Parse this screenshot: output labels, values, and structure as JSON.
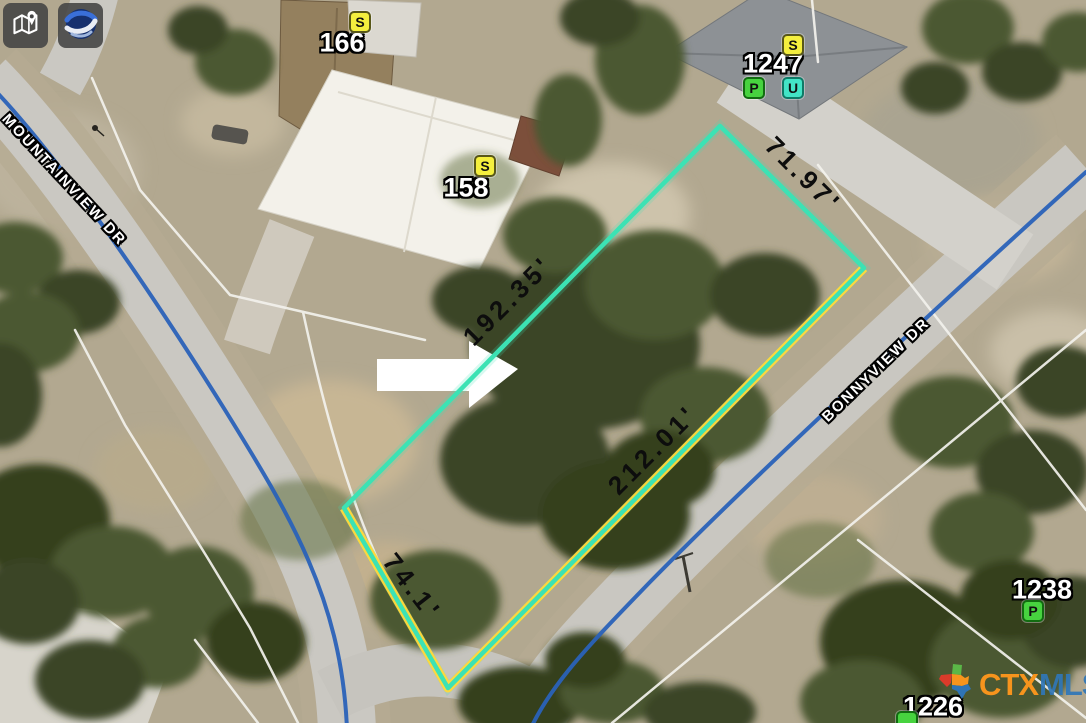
{
  "map_controls": {
    "tools": [
      {
        "icon": "map-layers-pin-icon"
      },
      {
        "icon": "google-earth-icon"
      }
    ]
  },
  "parcel": {
    "outline_color": "#3ce2b4",
    "road_frontage_color": "#ffd83c",
    "dimensions": [
      {
        "side": "northeast",
        "label": "71.97'"
      },
      {
        "side": "northwest",
        "label": "192.35'"
      },
      {
        "side": "southeast",
        "label": "212.01'"
      },
      {
        "side": "southwest",
        "label": "74.1'"
      }
    ],
    "pointer": "white-arrow-right"
  },
  "streets": [
    {
      "name": "MOUNTAINVIEW DR",
      "centerline_color": "#2a62b8"
    },
    {
      "name": "BONNYVIEW DR",
      "centerline_color": "#2a62b8"
    }
  ],
  "properties": [
    {
      "address": "166",
      "badges": [
        {
          "letter": "S",
          "type": "yellow"
        }
      ]
    },
    {
      "address": "158",
      "badges": [
        {
          "letter": "S",
          "type": "yellow"
        }
      ]
    },
    {
      "address": "1247",
      "badges": [
        {
          "letter": "S",
          "type": "yellow"
        },
        {
          "letter": "P",
          "type": "green"
        },
        {
          "letter": "U",
          "type": "teal"
        }
      ]
    },
    {
      "address": "1238",
      "badges": [
        {
          "letter": "P",
          "type": "green"
        }
      ]
    },
    {
      "address": "1226",
      "badges": []
    }
  ],
  "badge_colors": {
    "yellow": "#f4ef3e",
    "green": "#47d33f",
    "teal": "#43e4c6"
  },
  "watermark": {
    "ctx": "CTX",
    "mls": "MLS"
  }
}
